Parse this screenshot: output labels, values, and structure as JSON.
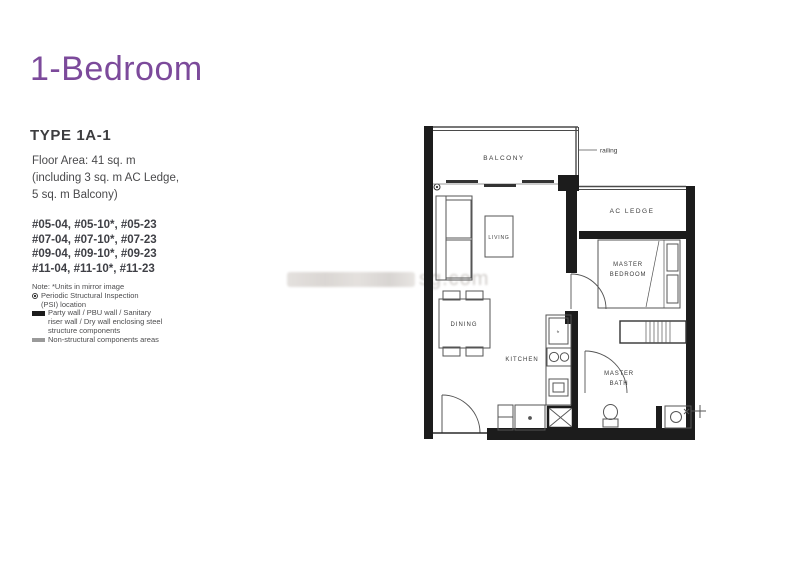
{
  "colors": {
    "accent_purple": "#7c4a9b",
    "wall_black": "#1c1c1c",
    "line_gray": "#555555",
    "watermark_gray": "#aaa39d"
  },
  "header": {
    "title": "1-Bedroom",
    "type_label": "TYPE 1A-1"
  },
  "details": {
    "floor_area_lines": [
      "Floor Area: 41 sq. m",
      "(including 3 sq. m AC Ledge,",
      "5 sq. m Balcony)"
    ],
    "unit_lines": [
      "#05-04, #05-10*, #05-23",
      "#07-04, #07-10*, #07-23",
      "#09-04, #09-10*, #09-23",
      "#11-04, #11-10*, #11-23"
    ]
  },
  "legend": {
    "note_line": "Note: *Units in mirror image",
    "psi_text_1": "Periodic Structural Inspection",
    "psi_text_2": "(PSI) location",
    "party_text_1": "Party wall / PBU wall / Sanitary",
    "party_text_2": "riser wall / Dry wall enclosing steel",
    "party_text_3": "structure components",
    "nonstructural_text": "Non-structural components areas"
  },
  "plan": {
    "labels": {
      "balcony": "BALCONY",
      "railing": "railing",
      "ac_ledge": "AC LEDGE",
      "living": "LIVING",
      "dining": "DINING",
      "kitchen": "KITCHEN",
      "master_bedroom_line1": "MASTER",
      "master_bedroom_line2": "BEDROOM",
      "master_bath_line1": "MASTER",
      "master_bath_line2": "BATH",
      "fridge": "fr"
    }
  },
  "watermark": {
    "text": "sg.com"
  }
}
